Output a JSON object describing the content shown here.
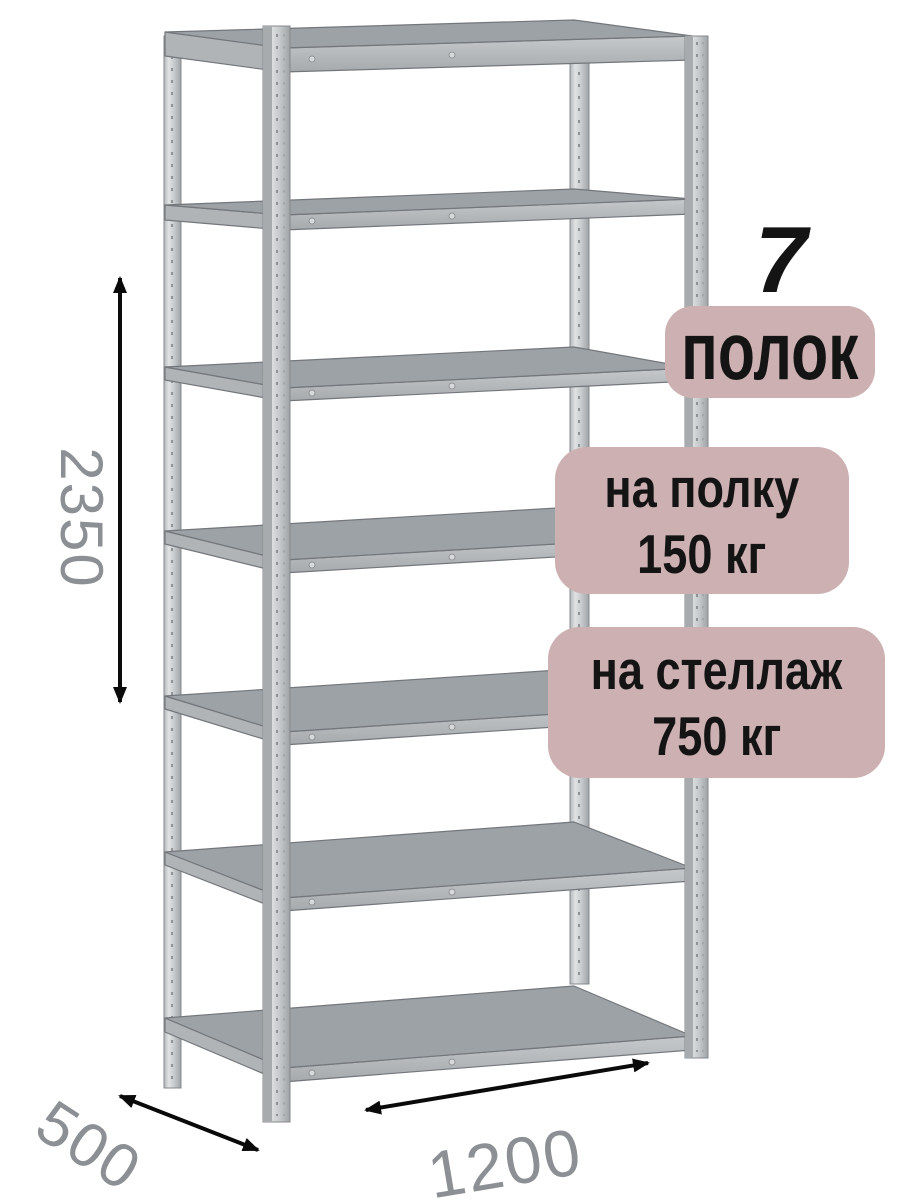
{
  "badges": {
    "shelves_number": "7",
    "shelves_caption": "полок",
    "shelf_load_line1": "на полку",
    "shelf_load_line2": "150 кг",
    "rack_load_line1": "на стеллаж",
    "rack_load_line2": "750 кг"
  },
  "dimensions": {
    "height": "2350",
    "depth": "500",
    "width": "1200"
  },
  "colors": {
    "background": "#ffffff",
    "badge_background": "#cdb0b1",
    "badge_text": "#141414",
    "dimension_text": "#8c9094",
    "arrow": "#0a0a0a",
    "metal_light": "#dfe1e2",
    "metal_mid": "#aeb1b4",
    "shelf_surface": "#9da2a6"
  }
}
